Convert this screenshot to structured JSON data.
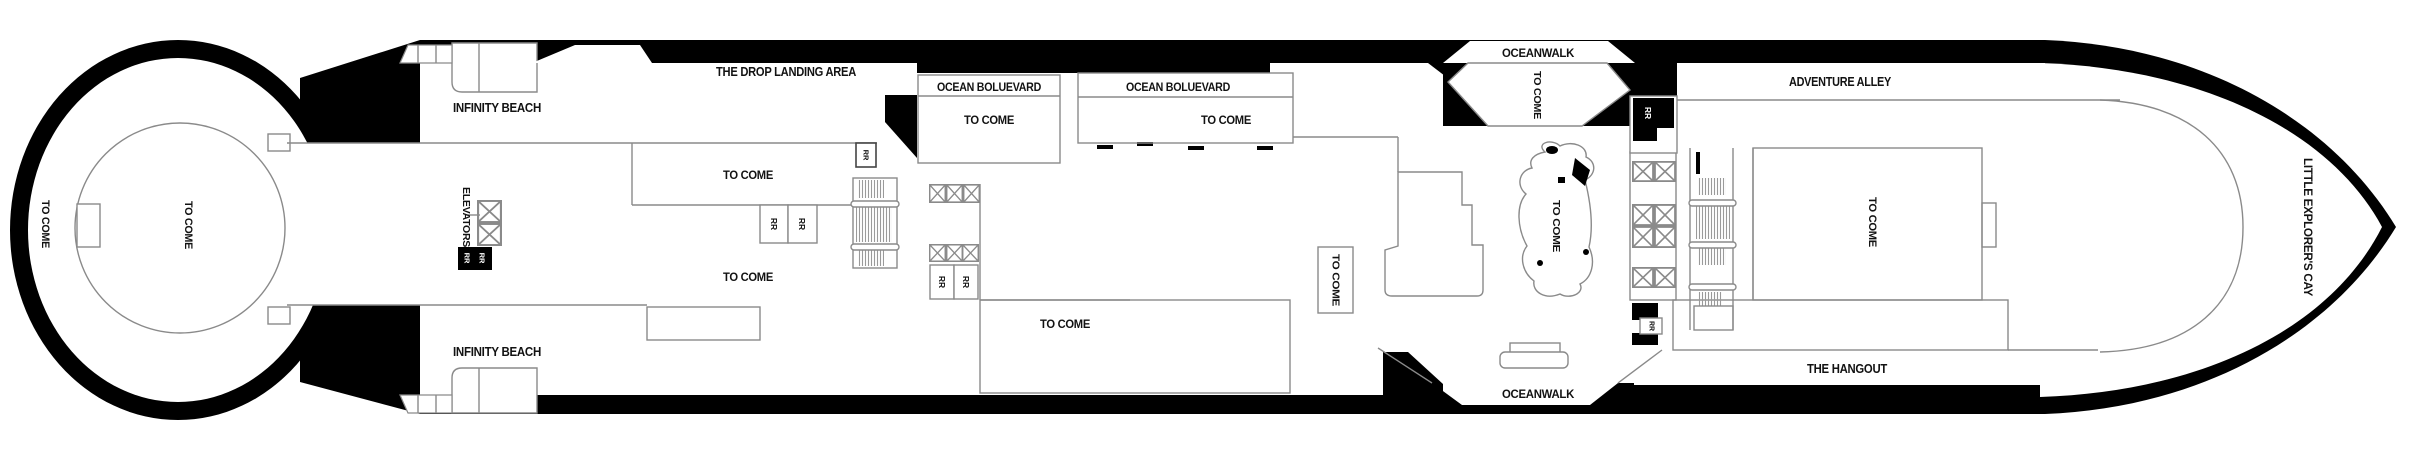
{
  "page": {
    "title": "Cruise ship deck plan",
    "width": 2425,
    "height": 460,
    "colors": {
      "hull": "#000000",
      "deck": "#ffffff",
      "walls": "#8a8a8a",
      "text": "#121212"
    }
  },
  "labels": {
    "the_drop": "THE DROP LANDING AREA",
    "infinity_beach": "INFINITY BEACH",
    "elevators": "ELEVATORS",
    "to_come": "TO COME",
    "ocean_boulevard": "OCEAN BOLUEVARD",
    "oceanwalk": "OCEANWALK",
    "adventure_alley": "ADVENTURE ALLEY",
    "the_hangout": "THE HANGOUT",
    "little_explorers_cay": "LITTLE EXPLORER'S CAY",
    "rr": "RR"
  }
}
